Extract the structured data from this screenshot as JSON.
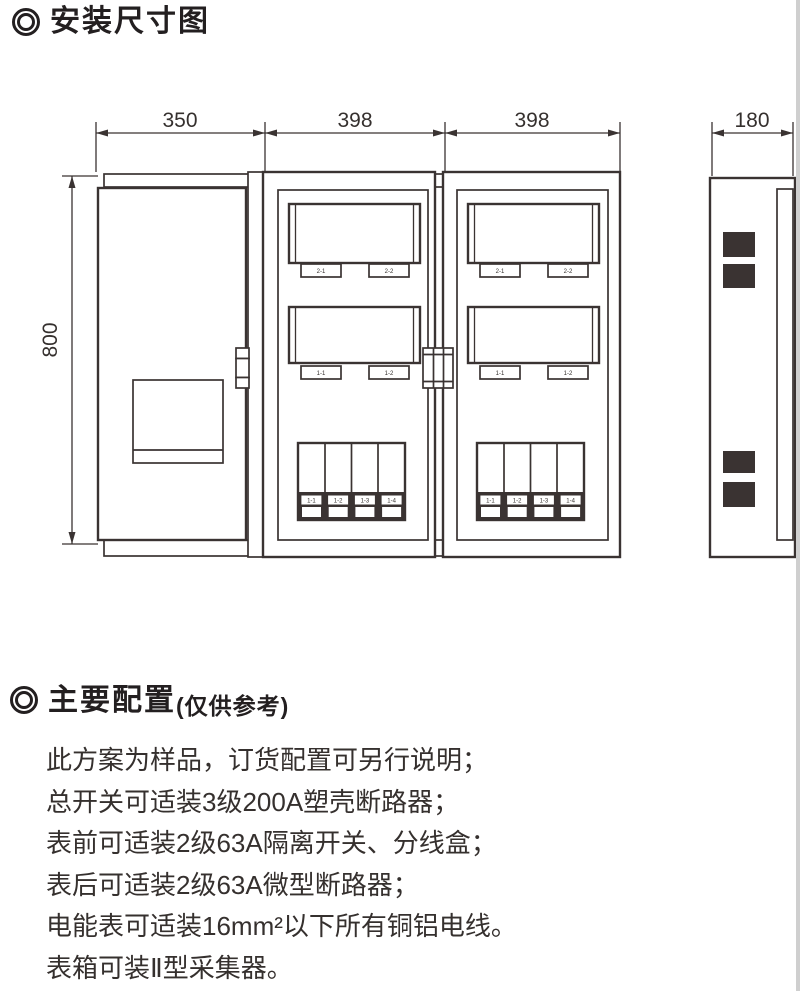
{
  "sections": {
    "install": {
      "title": "安装尺寸图"
    },
    "config": {
      "title": "主要配置",
      "subtitle": "(仅供参考)",
      "lines": [
        "此方案为样品，订货配置可另行说明；",
        "总开关可适装3级200A塑壳断路器；",
        "表前可适装2级63A隔离开关、分线盒；",
        "表后可适装2级63A微型断路器；",
        "电能表可适装16mm²以下所有铜铝电线。",
        "表箱可装Ⅱ型采集器。"
      ]
    }
  },
  "diagram": {
    "dim_width_left": "350",
    "dim_width_mid": "398",
    "dim_width_right": "398",
    "dim_depth": "180",
    "dim_height": "800",
    "meter_plate_labels_top": [
      "2-1",
      "2-2"
    ],
    "meter_plate_labels_mid": [
      "1-1",
      "1-2"
    ],
    "breaker_labels": [
      "1-1",
      "1-2",
      "1-3",
      "1-4"
    ]
  }
}
